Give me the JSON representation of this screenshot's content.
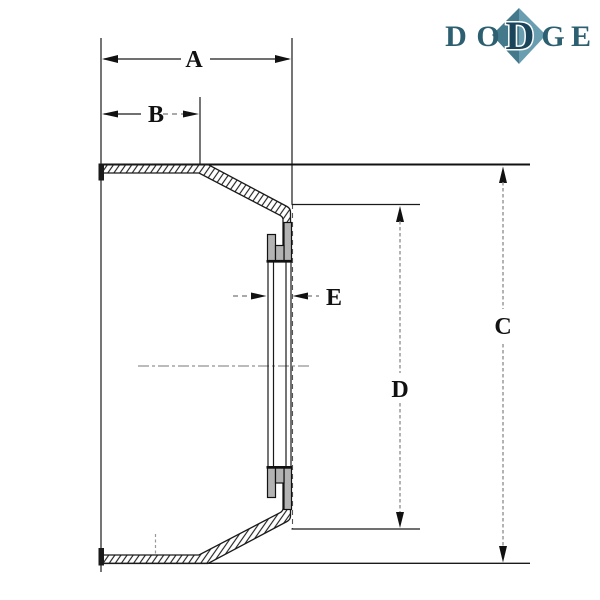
{
  "logo": {
    "brand": "DODGE",
    "letters": {
      "d1": "D",
      "o": "O",
      "d2": "D",
      "g": "G",
      "e": "E"
    },
    "colors": {
      "letter": "#2c5f70",
      "middle_letter": "#1a4459",
      "diamond_left": "#44798c",
      "diamond_right": "#699db0"
    }
  },
  "drawing": {
    "dimension_labels": {
      "a": "A",
      "b": "B",
      "c": "C",
      "d": "D",
      "e": "E"
    },
    "colors": {
      "line": "#1a1a1a",
      "leader_gray": "#8a8a8a",
      "bushing_fill": "#b3b3b3",
      "background": "#ffffff"
    }
  }
}
